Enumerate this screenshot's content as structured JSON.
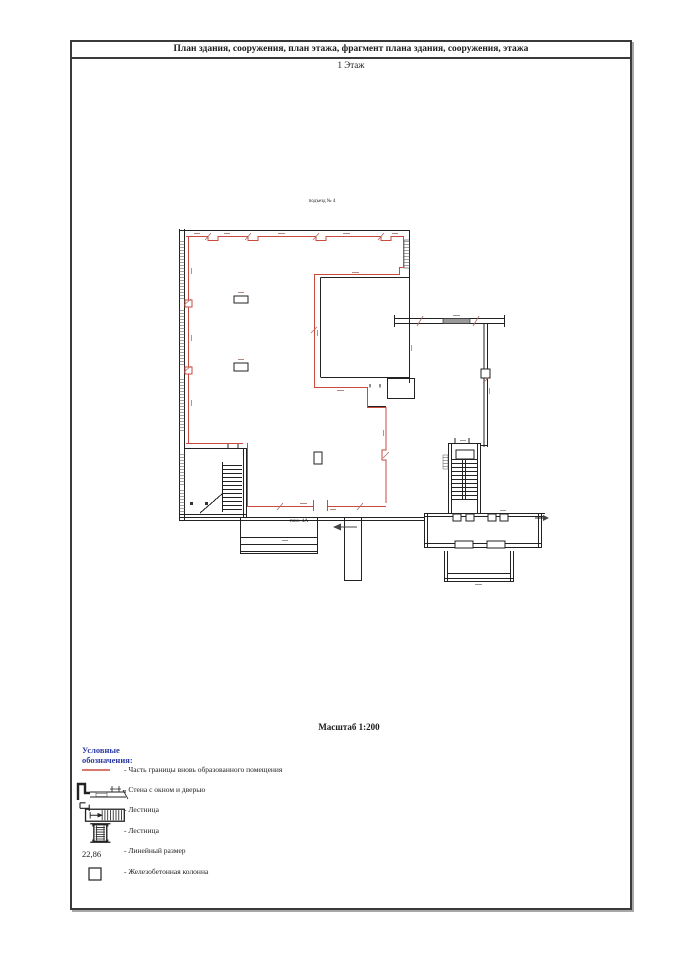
{
  "page": {
    "title": "План здания, сооружения, план этажа, фрагмент плана здания, сооружения, этажа",
    "floor_label": "1 Этаж",
    "scale_label": "Масштаб 1:200"
  },
  "plan": {
    "entrance_label": "подъезд № 4",
    "room_label": "пом. 4А"
  },
  "legend": {
    "header": "Условные обозначения:",
    "items": [
      {
        "symbol": "red-boundary-line",
        "label": "- Часть границы вновь образованного помещения"
      },
      {
        "symbol": "wall-window-door",
        "label": "- Стена с окном и дверью"
      },
      {
        "symbol": "stairs-plan",
        "label": "- Лестница"
      },
      {
        "symbol": "stairs-small",
        "label": "- Лестница"
      },
      {
        "symbol": "linear-dimension",
        "label": "- Линейный размер",
        "sample_value": "22,86"
      },
      {
        "symbol": "concrete-column",
        "label": "- Железобетонная колонна"
      }
    ]
  },
  "colors": {
    "boundary_red": "#c94b40",
    "wall_black": "#222222",
    "window_gray": "#999999",
    "legend_header_blue": "#2b3aa0"
  }
}
